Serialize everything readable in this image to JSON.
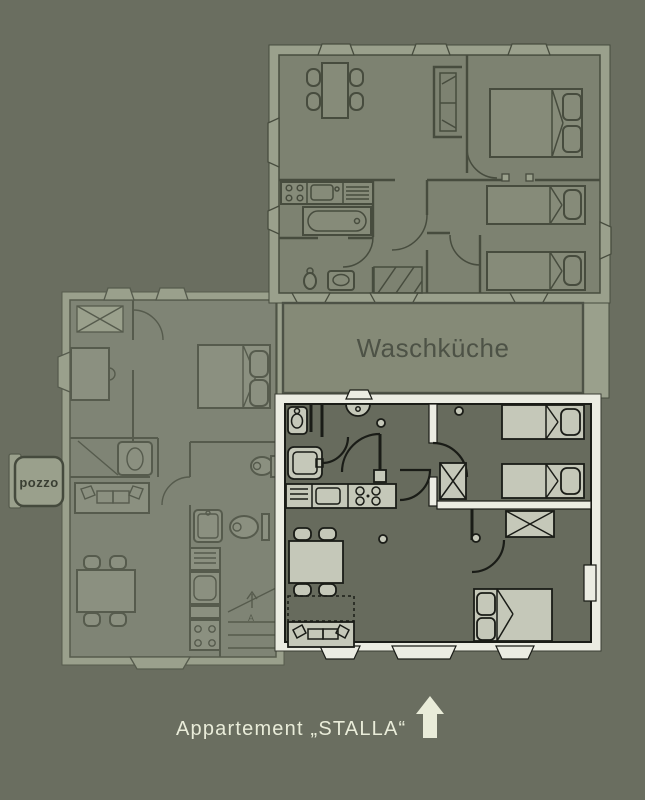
{
  "palette": {
    "bg": "#6a6e60",
    "ghost-band": "#9aa08c",
    "ghost-room": "#7d8271",
    "ghost-furn": "#868b79",
    "ghost-line": "#474c3e",
    "left-room": "#7f8475",
    "left-furn": "#8b9080",
    "left-line": "#565b4d",
    "laundry-fill": "#858a77",
    "laundry-text": "#4d5246",
    "stalla-white": "#ebece2",
    "stalla-room": "#676b5d",
    "stalla-line": "#1a1c17",
    "furniture": "#c5c8b9",
    "cream": "#e9ecd9"
  },
  "labels": {
    "laundry_room": "Waschküche",
    "well": "pozzo",
    "stairs": "A",
    "caption": "Appartement „STALLA“"
  }
}
